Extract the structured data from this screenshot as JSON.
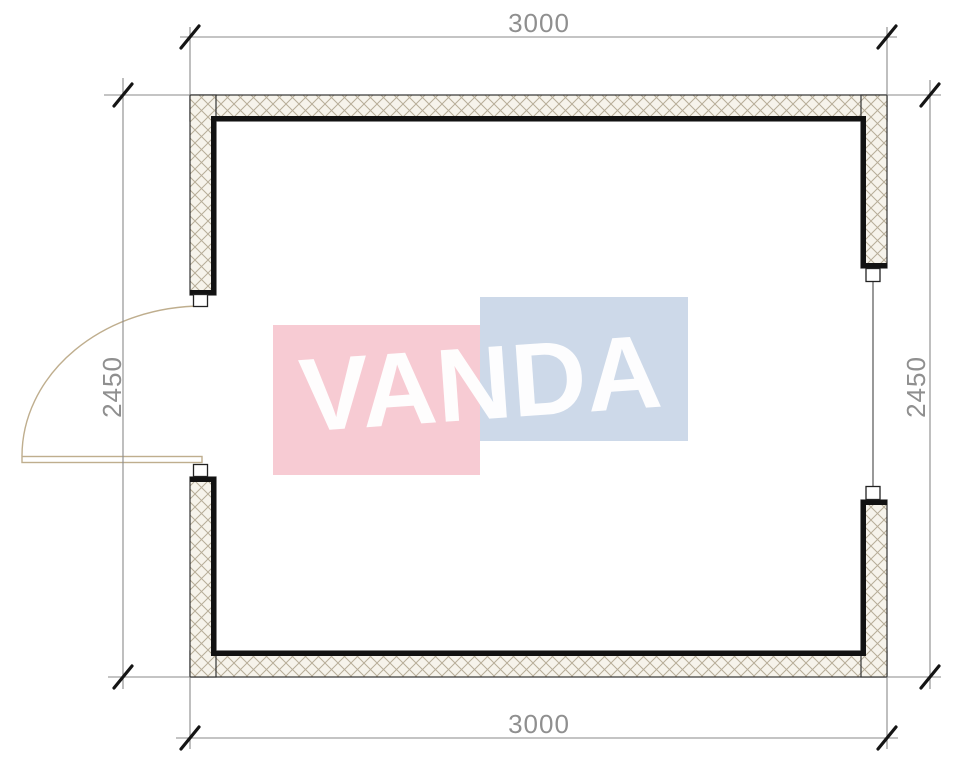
{
  "drawing": {
    "type": "floor-plan",
    "dimensions": {
      "top": "3000",
      "bottom": "3000",
      "left": "2450",
      "right": "2450"
    },
    "watermark": {
      "text": "VANDA",
      "pink_color": "#f7cbd3",
      "blue_color": "#cdd9e9",
      "text_color": "#ffffff"
    },
    "colors": {
      "wall_outline": "#333333",
      "wall_inner_line": "#121212",
      "wall_fill": "#f6f3eb",
      "hatch_line": "#b7ad98",
      "dimension_line": "#8a8a8a",
      "dimension_text": "#8f8f8f",
      "tick": "#151515",
      "door": "#bfae8e",
      "window_line": "#555555"
    }
  }
}
